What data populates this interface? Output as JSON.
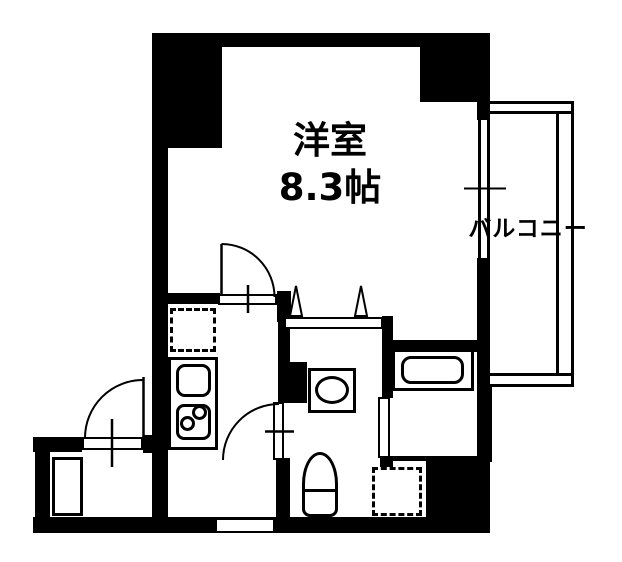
{
  "floorplan": {
    "type": "apartment-floor-plan",
    "background_color": "#ffffff",
    "line_color": "#000000",
    "labels": {
      "main_room_name": "洋室",
      "main_room_size": "8.3帖",
      "balcony": "バルコニー"
    },
    "rooms": [
      {
        "name": "western-room",
        "label": "洋室 8.3帖"
      },
      {
        "name": "balcony",
        "label": "バルコニー"
      },
      {
        "name": "kitchen-hall",
        "label": ""
      },
      {
        "name": "washroom-toilet",
        "label": ""
      },
      {
        "name": "bathroom",
        "label": ""
      },
      {
        "name": "entrance",
        "label": ""
      }
    ],
    "symbols": [
      "entrance-swing-door",
      "room-swing-door",
      "washroom-swing-door",
      "bifold-door-triangles",
      "sliding-window",
      "balcony-railing",
      "refrigerator-space-dashed",
      "kitchen-sink",
      "two-burner-stove",
      "washbasin-oval",
      "toilet",
      "bathtub",
      "washing-machine-space-dashed",
      "shoe-cabinet"
    ]
  }
}
